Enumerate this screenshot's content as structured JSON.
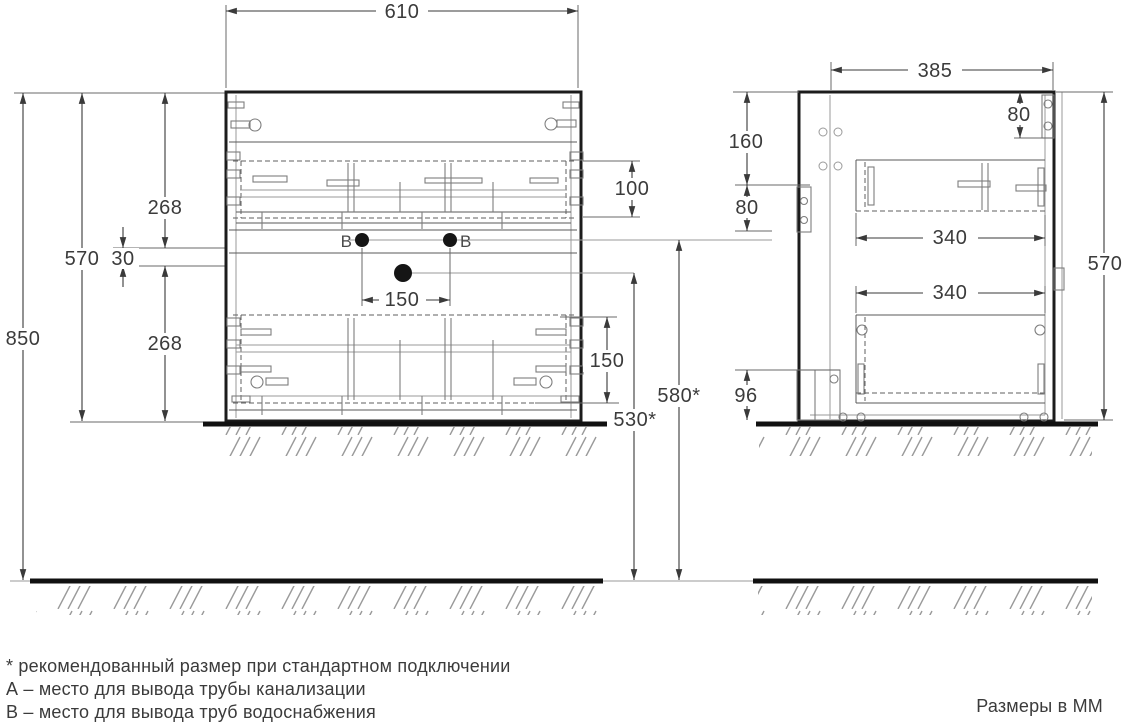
{
  "colors": {
    "outline": "#1c1c1c",
    "thin_line": "#7d7d7d",
    "dimension": "#3a3a3a",
    "text": "#3b3b3b",
    "hole_fill": "#151515",
    "background": "#ffffff"
  },
  "front_view": {
    "dims": {
      "width": "610",
      "total_height": "850",
      "height": "570",
      "upper_offset": "268",
      "holes_gap": "30",
      "lower_offset": "268",
      "upper_drawer_clearance": "100",
      "supply_holes_spacing": "150",
      "lower_drawer_clearance": "150",
      "supply_height": "580*",
      "drain_height": "530*"
    },
    "markers": {
      "b_left": "В",
      "b_right": "В"
    }
  },
  "side_view": {
    "dims": {
      "depth": "385",
      "height": "570",
      "plate_top_offset": "160",
      "plate_height": "80",
      "bracket_height": "80",
      "upper_drawer_depth": "340",
      "lower_drawer_depth": "340",
      "plinth_height": "96"
    }
  },
  "footer": {
    "note_recommended": "* рекомендованный размер при стандартном подключении",
    "note_a": "А – место для вывода трубы канализации",
    "note_b": "В – место для вывода труб водоснабжения",
    "units_label": "Размеры в ММ"
  }
}
